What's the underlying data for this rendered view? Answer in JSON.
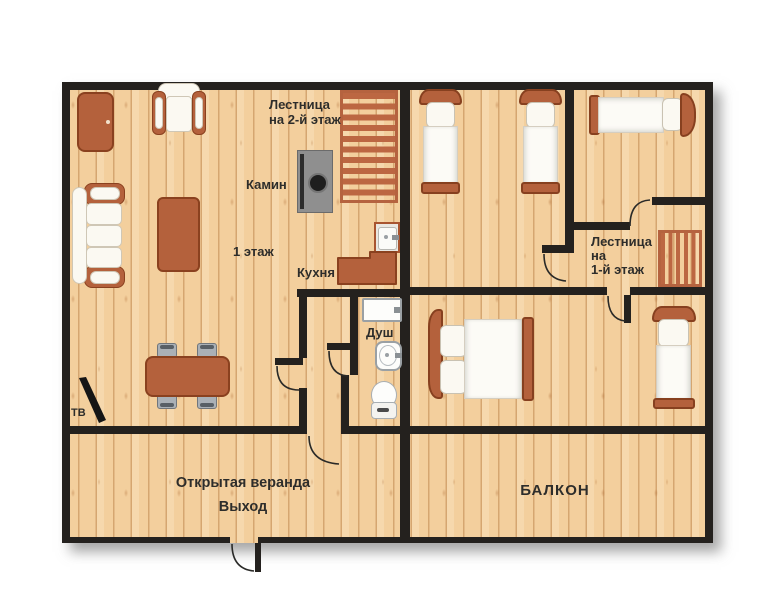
{
  "plan": {
    "type": "house-floor-plan",
    "language": "ru",
    "floor1": {
      "labels": {
        "stairs_up_line1": "Лестница",
        "stairs_up_line2": "на 2-й этаж",
        "fireplace": "Камин",
        "floor_name": "1 этаж",
        "kitchen": "Кухня",
        "shower": "Душ",
        "tv": "ТВ",
        "veranda": "Открытая веранда",
        "exit": "Выход"
      },
      "furniture": [
        "cabinet",
        "armchair",
        "sofa",
        "coffee-table",
        "fireplace",
        "stairs-up",
        "kitchen-sink",
        "kitchen-counter",
        "shower-tray",
        "washbasin",
        "toilet",
        "dining-table",
        "chair",
        "chair",
        "chair",
        "chair",
        "tv"
      ]
    },
    "floor2": {
      "labels": {
        "stairs_down_line1": "Лестница",
        "stairs_down_line2": "на",
        "stairs_down_line3": "1-й этаж",
        "balcony": "БАЛКОН"
      },
      "furniture": [
        "single-bed",
        "single-bed",
        "single-bed-horizontal",
        "double-bed",
        "single-bed",
        "stairs-down"
      ]
    },
    "colors": {
      "wall": "#24211e",
      "floor_wood": "#f3cf9d",
      "plank_line": "#b0733a",
      "furniture_brown": "#b4613c",
      "furniture_border": "#8a411f",
      "stairs_accent": "#b5633f",
      "fireplace_gray": "#8f8f8f",
      "fixture_white": "#fbf9f2",
      "text": "#2d2d2b",
      "background": "#ffffff"
    }
  }
}
